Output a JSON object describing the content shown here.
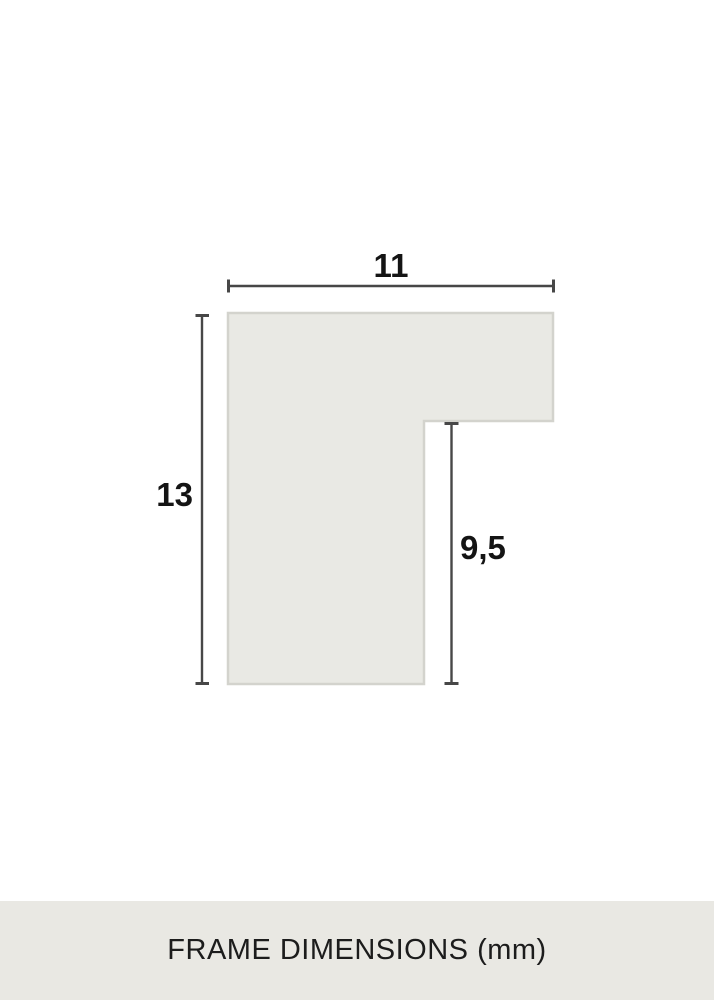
{
  "diagram": {
    "dimensions": {
      "width": {
        "value": "11",
        "orientation": "horizontal",
        "side": "top"
      },
      "height": {
        "value": "13",
        "orientation": "vertical",
        "side": "left"
      },
      "rabbet_depth": {
        "value": "9,5",
        "orientation": "vertical",
        "side": "inner-right"
      }
    }
  },
  "caption": {
    "text": "FRAME DIMENSIONS (mm)",
    "unit": "mm"
  },
  "colors": {
    "background": "#ffffff",
    "shape_fill": "#e9e9e4",
    "shape_border": "#d3d3cd",
    "dimension_line": "#474747",
    "label_text": "#141414",
    "caption_bg": "#e9e8e3",
    "caption_text": "#1c1c1c"
  }
}
